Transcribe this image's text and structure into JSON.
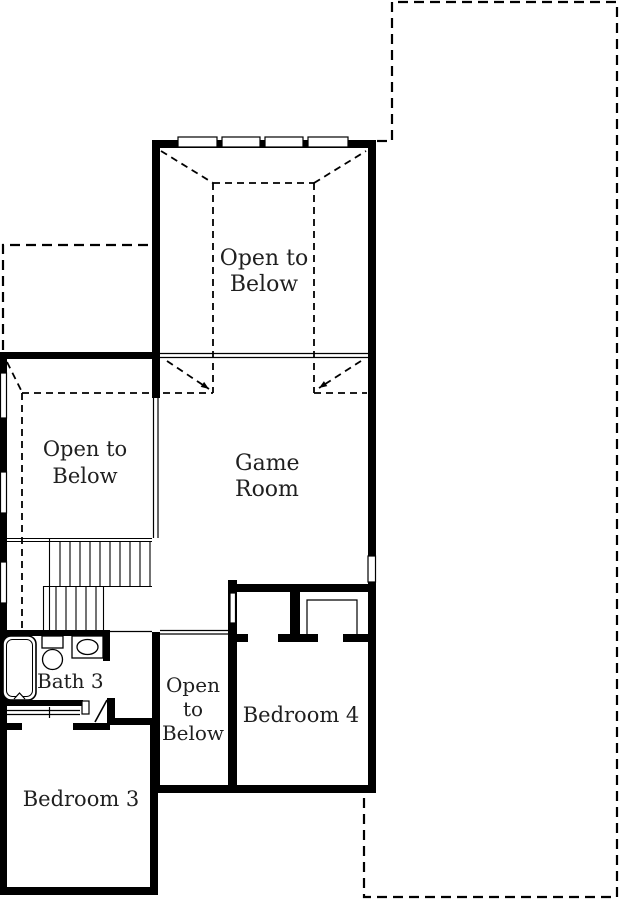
{
  "colors": {
    "wall": "#000000",
    "background": "#ffffff",
    "text": "#1f1f1f"
  },
  "rooms": {
    "open_below_upper": {
      "line1": "Open to",
      "line2": "Below"
    },
    "game_room": {
      "line1": "Game",
      "line2": "Room"
    },
    "open_below_left": {
      "line1": "Open to",
      "line2": "Below"
    },
    "bath3": {
      "label": "Bath 3"
    },
    "open_below_mid": {
      "line1": "Open",
      "line2": "to",
      "line3": "Below"
    },
    "bedroom4": {
      "label": "Bedroom 4"
    },
    "bedroom3": {
      "label": "Bedroom 3"
    }
  }
}
